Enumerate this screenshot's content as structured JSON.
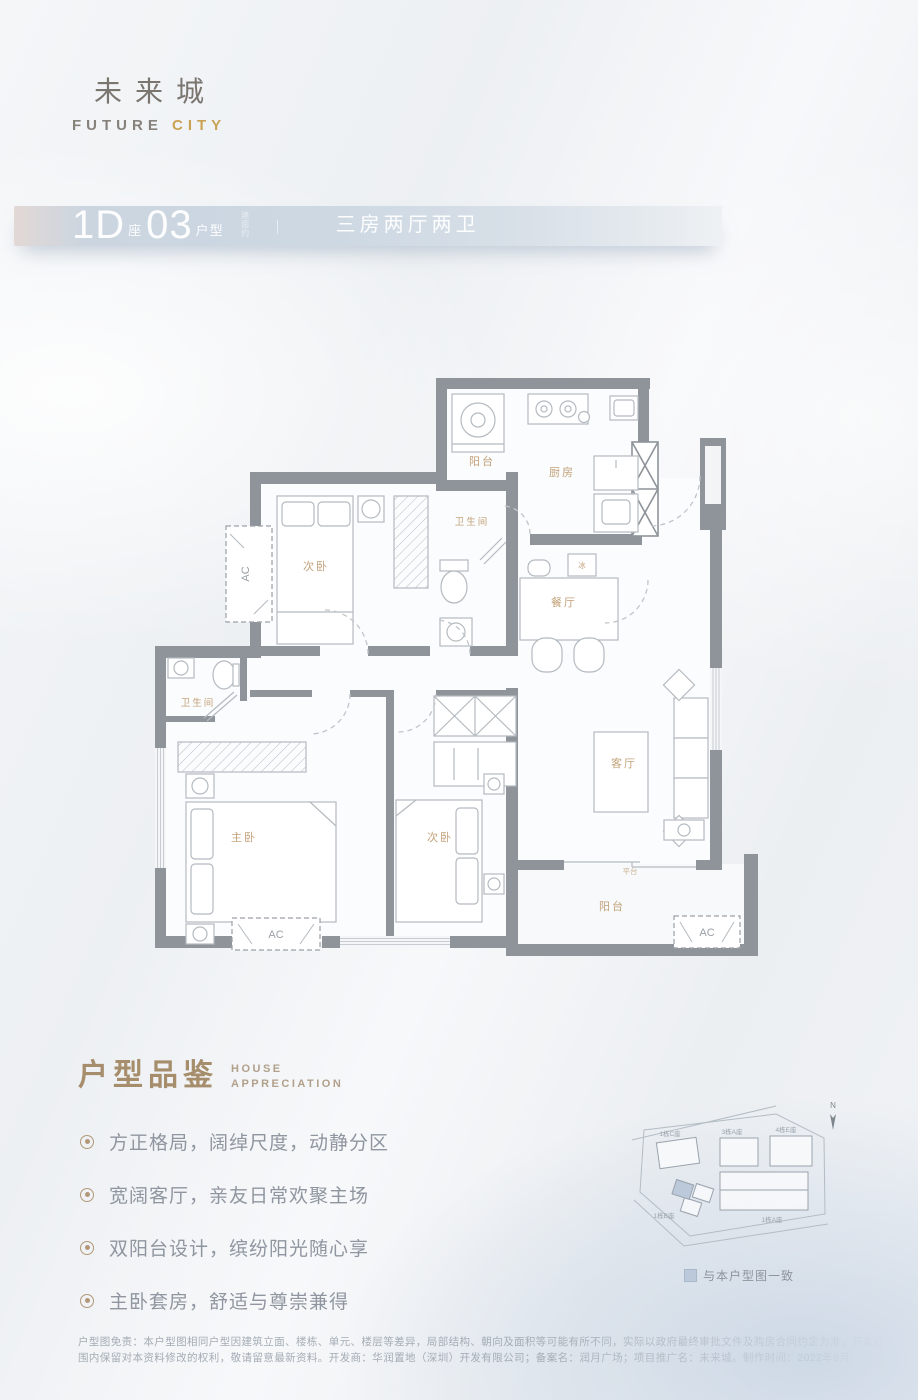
{
  "brand": {
    "name_cn": "未来城",
    "name_en_primary": "FUTURE ",
    "name_en_accent": "CITY"
  },
  "header": {
    "block_number": "1D",
    "block_suffix": "座",
    "unit_number": "03",
    "unit_suffix": "户型",
    "area_note": "建面约",
    "layout_summary": "三房两厅两卫"
  },
  "floorplan": {
    "labels": {
      "balcony_top": "阳台",
      "kitchen": "厨房",
      "bedroom_top": "次卧",
      "bathroom_top": "卫生间",
      "dining": "餐厅",
      "fridge": "冰",
      "bathroom_left": "卫生间",
      "master_bedroom": "主卧",
      "bedroom_bottom": "次卧",
      "living": "客厅",
      "balcony_bottom": "阳台",
      "platform": "平台",
      "ac": "AC"
    }
  },
  "appreciation": {
    "title_cn": "户型品鉴",
    "title_en_line1": "HOUSE",
    "title_en_line2": "APPRECIATION",
    "features": [
      "方正格局，阔绰尺度，动静分区",
      "宽阔客厅，亲友日常欢聚主场",
      "双阳台设计，缤纷阳光随心享",
      "主卧套房，舒适与尊崇兼得"
    ]
  },
  "sitemap": {
    "north_label": "N",
    "legend_text": "与本户型图一致",
    "buildings": [
      "1栋C座",
      "3栋A座",
      "4栋E座",
      "1栋B座",
      "1栋A座"
    ]
  },
  "disclaimer": {
    "line1": "户型图免责：本户型图相同户型因建筑立面、楼栋、单元、楼层等差异，局部结构、朝向及面积等可能有所不同，实际以政府最终审批文件及购房合同约定为准，开发商在法律允许范",
    "line2": "围内保留对本资料修改的权利，敬请留意最新资料。开发商：华润置地（深圳）开发有限公司；备案名：润月广场；项目推广名：未来城。制作时间：2022年9月"
  },
  "colors": {
    "accent_gold": "#c9a254",
    "label_gold": "#c2a27a",
    "wall_gray": "#8e949a",
    "band_blue": "#ccd7e2",
    "legend_blue": "#bcc9da"
  }
}
